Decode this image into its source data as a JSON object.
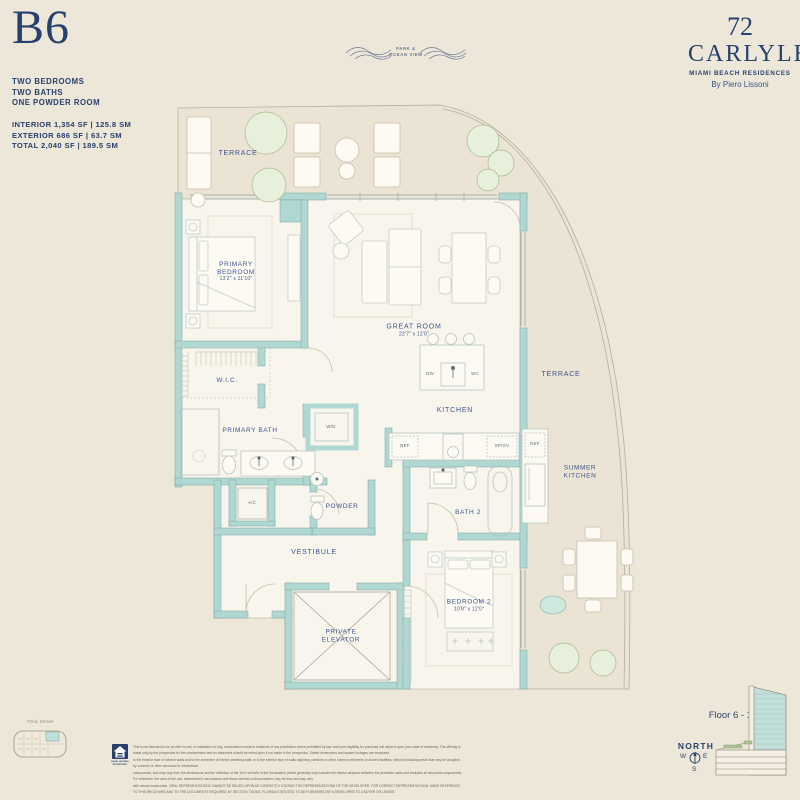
{
  "unit": {
    "name": "B6",
    "features": [
      "TWO BEDROOMS",
      "TWO BATHS",
      "ONE POWDER ROOM"
    ],
    "areas": [
      "INTERIOR 1,354 SF | 125.8 SM",
      "EXTERIOR 686 SF | 63.7 SM",
      "TOTAL 2,040 SF | 189.5 SM"
    ]
  },
  "view": {
    "line1": "PARK &",
    "line2": "OCEAN VIEW"
  },
  "brand": {
    "number": "72",
    "name": "CARLYLE",
    "tagline": "MIAMI BEACH RESIDENCES",
    "byline": "By Piero Lissoni"
  },
  "rooms": {
    "terrace_top": {
      "name": "TERRACE"
    },
    "primary_bedroom": {
      "l1": "PRIMARY",
      "l2": "BEDROOM",
      "dims": "13'2\" x 11'10\""
    },
    "great_room": {
      "name": "GREAT ROOM",
      "dims": "22'7\" x 12'0\""
    },
    "kitchen": {
      "name": "KITCHEN"
    },
    "wic": {
      "name": "W.I.C."
    },
    "primary_bath": {
      "name": "PRIMARY BATH"
    },
    "powder": {
      "name": "POWDER"
    },
    "vestibule": {
      "name": "VESTIBULE"
    },
    "private_elevator": {
      "l1": "PRIVATE",
      "l2": "ELEVATOR"
    },
    "bath_2": {
      "name": "BATH 2"
    },
    "bedroom_2": {
      "name": "BEDROOM 2",
      "dims": "10'8\" x 12'0\""
    },
    "terrace_right": {
      "name": "TERRACE"
    },
    "summer_kitchen": {
      "l1": "SUMMER",
      "l2": "KITCHEN"
    }
  },
  "appliances": {
    "dw": "DW",
    "wc": "WC",
    "ref": "REF",
    "spov": "SP/OV",
    "wd": "W/D",
    "ac": "A/C",
    "ref_summer": "REF"
  },
  "keyplan": {
    "street": "72nd Street"
  },
  "footer": {
    "floor_range": "Floor 6 - 17",
    "compass": {
      "north": "NORTH",
      "w": "W",
      "e": "E",
      "s": "S"
    },
    "equal_housing": "EQUAL HOUSING OPPORTUNITY",
    "disclaimer": [
      "This is not intended to be an offer to sell, or solicitation to buy, condominium units to residents of any jurisdiction where prohibited by law, and your eligibility for purchase will depend upon your state of residency. The offering is made only by the prospectus for the condominium and no statement should be relied upon if not made in the prospectus. Stated dimensions and square footages are measured",
      "to the exterior face of exterior walls and to the centerline of interior demising walls or to the exterior face of walls adjoining corridors or other common elements or shared facilities, without excluding areas that may be occupied by columns or other structural or mechanical",
      "components, and may vary from the dimensions and the definition of the 'Unit' set forth in the Declaration (which generally only includes the interior airspace between the perimeter walls and excludes all structural components). For reference, the area of the unit, determined in accordance with these defined unit boundaries, may be less and may vary",
      "with actual construction. ORAL REPRESENTATIONS CANNOT BE RELIED UPON AS CORRECTLY STATING THE REPRESENTATIONS OF THE DEVELOPER. FOR CORRECT REPRESENTATIONS, MAKE REFERENCE TO THIS BROCHURE AND TO THE DOCUMENTS REQUIRED BY SECTION 718.503, FLORIDA STATUTES, TO BE FURNISHED BY A DEVELOPER TO A BUYER OR LESSEE."
    ]
  },
  "colors": {
    "navy": "#27416E",
    "wall_teal": "#B0D8D2",
    "cream": "#EDE7D9",
    "interior": "#F8F5ED",
    "terrace": "#EBE3D3"
  }
}
